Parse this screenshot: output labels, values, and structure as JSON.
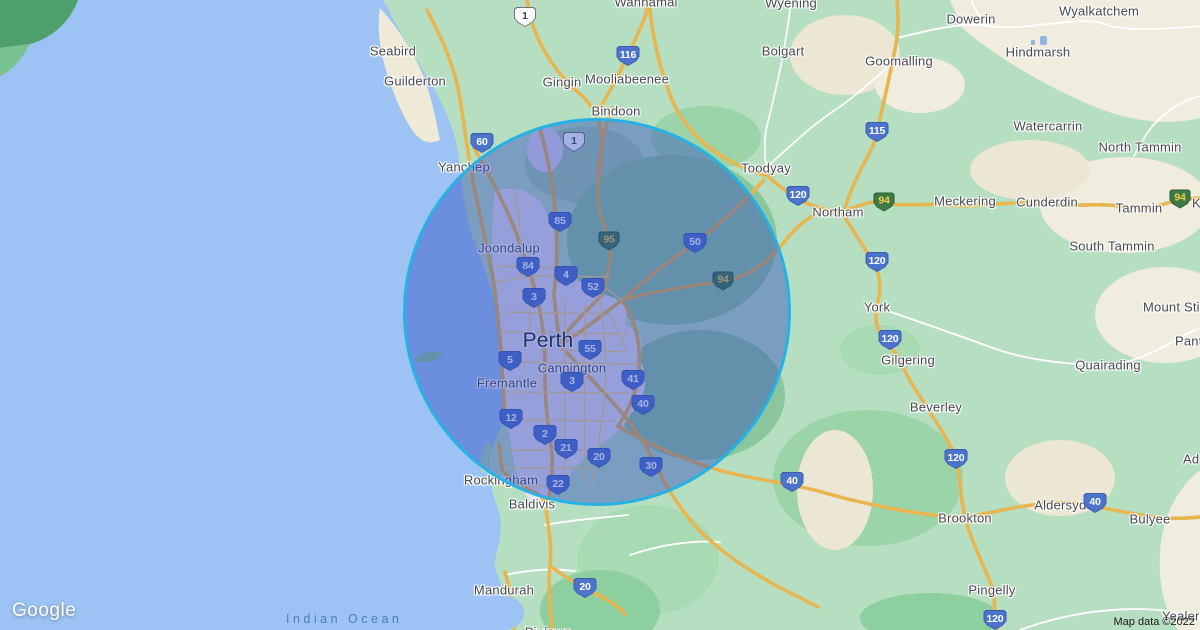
{
  "map": {
    "logo": "Google",
    "attribution": "Map data ©2022",
    "ocean_label": "Indian Ocean",
    "colors": {
      "ocean": "#9cc3f4",
      "land": "#b6dfc2",
      "beige_terrain": "#f0ecde",
      "urban": "#e5e1ee",
      "road_yellow": "#fbe189",
      "circle_fill": "rgba(43,70,190,0.42)",
      "circle_stroke": "#27b2e6",
      "shield_blue": "#4d74cc",
      "shield_green": "#3d7a45",
      "water_label_blue": "#4c7dc0"
    },
    "circle": {
      "cx": 597,
      "cy": 312,
      "r": 194,
      "fill": "rgba(43,70,190,0.42)",
      "stroke": "#27b2e6"
    },
    "towns": [
      {
        "label": "Seabird",
        "x": 393,
        "y": 51
      },
      {
        "label": "Guilderton",
        "x": 415,
        "y": 81
      },
      {
        "label": "Yanchep",
        "x": 464,
        "y": 167
      },
      {
        "label": "Gingin",
        "x": 562,
        "y": 82
      },
      {
        "label": "Mooliabeenee",
        "x": 627,
        "y": 79
      },
      {
        "label": "Bindoon",
        "x": 616,
        "y": 111
      },
      {
        "label": "Wannamal",
        "x": 646,
        "y": 2
      },
      {
        "label": "Wyening",
        "x": 791,
        "y": 3
      },
      {
        "label": "Bolgart",
        "x": 783,
        "y": 51
      },
      {
        "label": "Goomalling",
        "x": 899,
        "y": 61
      },
      {
        "label": "Dowerin",
        "x": 971,
        "y": 19
      },
      {
        "label": "Wyalkatchem",
        "x": 1099,
        "y": 11
      },
      {
        "label": "Hindmarsh",
        "x": 1038,
        "y": 52
      },
      {
        "label": "Watercarrin",
        "x": 1048,
        "y": 126
      },
      {
        "label": "North Tammin",
        "x": 1140,
        "y": 147
      },
      {
        "label": "Toodyay",
        "x": 766,
        "y": 168
      },
      {
        "label": "Northam",
        "x": 838,
        "y": 212
      },
      {
        "label": "Meckering",
        "x": 965,
        "y": 201
      },
      {
        "label": "Cunderdin",
        "x": 1047,
        "y": 202
      },
      {
        "label": "Tammin",
        "x": 1139,
        "y": 208
      },
      {
        "label": "K",
        "x": 1192,
        "y": 203,
        "anchor": "left"
      },
      {
        "label": "South Tammin",
        "x": 1112,
        "y": 246
      },
      {
        "label": "York",
        "x": 877,
        "y": 307
      },
      {
        "label": "Mount Stirling",
        "x": 1143,
        "y": 307,
        "anchor": "left"
      },
      {
        "label": "Gilgering",
        "x": 908,
        "y": 360
      },
      {
        "label": "Quairading",
        "x": 1108,
        "y": 365
      },
      {
        "label": "Pantapin",
        "x": 1175,
        "y": 341,
        "anchor": "left"
      },
      {
        "label": "Beverley",
        "x": 936,
        "y": 407
      },
      {
        "label": "Joondalup",
        "x": 509,
        "y": 248
      },
      {
        "label": "Perth",
        "x": 548,
        "y": 341,
        "size": "large"
      },
      {
        "label": "Cannington",
        "x": 572,
        "y": 368
      },
      {
        "label": "Fremantle",
        "x": 507,
        "y": 383
      },
      {
        "label": "Rockingham",
        "x": 501,
        "y": 480
      },
      {
        "label": "Baldivis",
        "x": 532,
        "y": 504
      },
      {
        "label": "Brookton",
        "x": 965,
        "y": 518
      },
      {
        "label": "Aldersyde",
        "x": 1064,
        "y": 505
      },
      {
        "label": "Ad",
        "x": 1183,
        "y": 459,
        "anchor": "left"
      },
      {
        "label": "Bulyee",
        "x": 1150,
        "y": 519
      },
      {
        "label": "Mandurah",
        "x": 504,
        "y": 590
      },
      {
        "label": "Pinjarra",
        "x": 548,
        "y": 632
      },
      {
        "label": "Pingelly",
        "x": 992,
        "y": 590
      },
      {
        "label": "Yealering",
        "x": 1162,
        "y": 616,
        "anchor": "left"
      }
    ],
    "shields": [
      {
        "num": "1",
        "type": "white",
        "x": 525,
        "y": 17
      },
      {
        "num": "1",
        "type": "white",
        "x": 574,
        "y": 142
      },
      {
        "num": "116",
        "type": "blue",
        "x": 628,
        "y": 56
      },
      {
        "num": "60",
        "type": "blue",
        "x": 482,
        "y": 143
      },
      {
        "num": "85",
        "type": "blue",
        "x": 560,
        "y": 222
      },
      {
        "num": "95",
        "type": "green",
        "x": 609,
        "y": 241
      },
      {
        "num": "50",
        "type": "blue",
        "x": 695,
        "y": 243
      },
      {
        "num": "84",
        "type": "blue",
        "x": 528,
        "y": 267
      },
      {
        "num": "4",
        "type": "blue",
        "x": 566,
        "y": 276
      },
      {
        "num": "52",
        "type": "blue",
        "x": 593,
        "y": 288
      },
      {
        "num": "94",
        "type": "green",
        "x": 723,
        "y": 281
      },
      {
        "num": "3",
        "type": "blue",
        "x": 534,
        "y": 298
      },
      {
        "num": "115",
        "type": "blue",
        "x": 877,
        "y": 132
      },
      {
        "num": "120",
        "type": "blue",
        "x": 798,
        "y": 196
      },
      {
        "num": "94",
        "type": "green",
        "x": 884,
        "y": 202
      },
      {
        "num": "94",
        "type": "green",
        "x": 1180,
        "y": 199
      },
      {
        "num": "120",
        "type": "blue",
        "x": 877,
        "y": 262
      },
      {
        "num": "55",
        "type": "blue",
        "x": 590,
        "y": 350
      },
      {
        "num": "5",
        "type": "blue",
        "x": 510,
        "y": 361
      },
      {
        "num": "3",
        "type": "blue",
        "x": 572,
        "y": 382
      },
      {
        "num": "41",
        "type": "blue",
        "x": 633,
        "y": 380
      },
      {
        "num": "40",
        "type": "blue",
        "x": 643,
        "y": 405
      },
      {
        "num": "12",
        "type": "blue",
        "x": 511,
        "y": 419
      },
      {
        "num": "2",
        "type": "blue",
        "x": 545,
        "y": 435
      },
      {
        "num": "21",
        "type": "blue",
        "x": 566,
        "y": 449
      },
      {
        "num": "20",
        "type": "blue",
        "x": 599,
        "y": 458
      },
      {
        "num": "30",
        "type": "blue",
        "x": 651,
        "y": 467
      },
      {
        "num": "22",
        "type": "blue",
        "x": 558,
        "y": 485
      },
      {
        "num": "120",
        "type": "blue",
        "x": 890,
        "y": 340
      },
      {
        "num": "120",
        "type": "blue",
        "x": 956,
        "y": 459
      },
      {
        "num": "40",
        "type": "blue",
        "x": 792,
        "y": 482
      },
      {
        "num": "40",
        "type": "blue",
        "x": 1095,
        "y": 503
      },
      {
        "num": "120",
        "type": "blue",
        "x": 995,
        "y": 620
      },
      {
        "num": "20",
        "type": "blue",
        "x": 585,
        "y": 588
      }
    ]
  }
}
